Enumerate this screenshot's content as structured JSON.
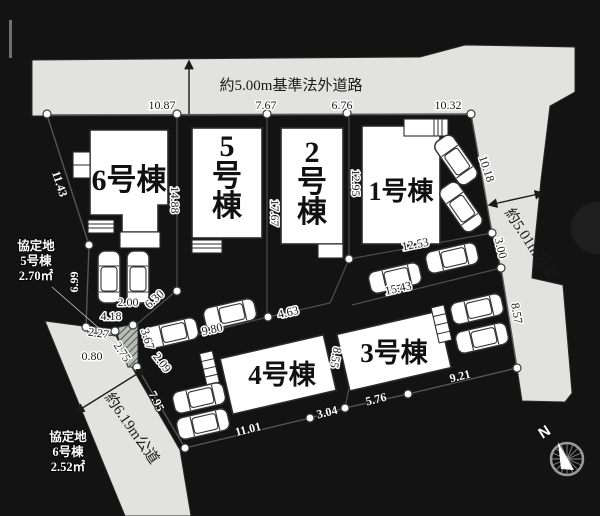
{
  "roads": {
    "top_label": "約5.00m基準法外道路",
    "right_label": "約5.01m公道",
    "bottom_left_label": "約6.19m公道"
  },
  "buildings": [
    {
      "name": "6号棟"
    },
    {
      "name": "5号棟"
    },
    {
      "name": "2号棟"
    },
    {
      "name": "1号棟"
    },
    {
      "name": "4号棟"
    },
    {
      "name": "3号棟"
    }
  ],
  "agreement_areas": [
    {
      "title": "協定地",
      "building": "5号棟",
      "area": "2.70㎡"
    },
    {
      "title": "協定地",
      "building": "6号棟",
      "area": "2.52㎡"
    }
  ],
  "dims": [
    "10.87",
    "7.67",
    "6.76",
    "10.32",
    "11.43",
    "14.88",
    "17.67",
    "12.95",
    "10.18",
    "3.00",
    "8.57",
    "12.53",
    "15.43",
    "4.63",
    "9.80",
    "6.99",
    "2.00",
    "4.18",
    "6.30",
    "2.27",
    "0.80",
    "2.75",
    "3.67",
    "2.09",
    "7.95",
    "11.01",
    "3.04",
    "5.76",
    "9.21",
    "8.55"
  ],
  "compass": {
    "north_label": "N"
  },
  "colors": {
    "background": "#131313",
    "road_gray": "#e2e2e1",
    "site_green": "#d8ebcd",
    "building_white": "#ffffff"
  }
}
